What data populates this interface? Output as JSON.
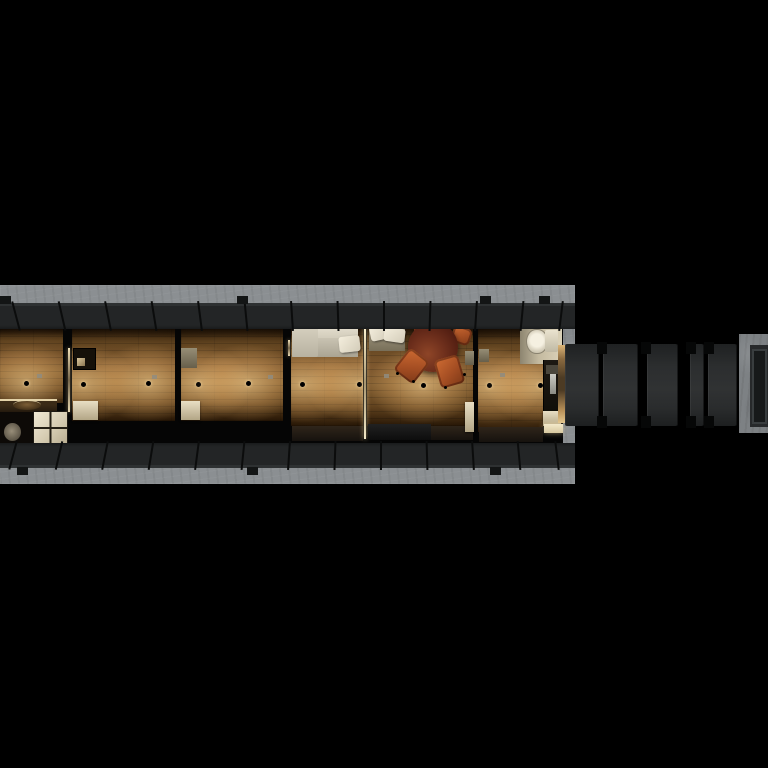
{
  "scene": {
    "title": "narrowboat-tiny-home-top-down-night-render",
    "canvas": {
      "w": 768,
      "h": 768,
      "background": "#000000"
    },
    "palette": {
      "background": "#000000",
      "concrete": "#8b8f92",
      "concrete_dark": "#6d7073",
      "hull": "#232526",
      "hull_seam": "#0b0c0c",
      "wood_mid": "#7a5427",
      "light_glow": "#ffd896",
      "sofa_cream": "#cfc9b8",
      "pillow_white": "#ece6d6",
      "table_mahogany": "#6b2d1b",
      "chair_copper": "#b35a2a",
      "cabinet_cream": "#d8cdb2",
      "tile_cream": "#d6ccb2",
      "counter_dark": "#16120d",
      "threshold_tan": "#c8a468",
      "gangway_panel": "#2b2d2e",
      "platform_frame": "#7d8184"
    },
    "dock": {
      "x": 0,
      "y": 285,
      "w": 575,
      "h": 199
    },
    "hull": {
      "interior": {
        "x": 0,
        "y": 326,
        "w": 563,
        "h": 119
      },
      "top_band": {
        "x": 0,
        "y": 303,
        "w": 575,
        "h": 26,
        "seams": [
          15,
          61,
          107,
          153,
          199,
          245,
          291,
          337,
          383,
          429,
          475,
          521,
          560
        ],
        "tabs": [
          0,
          237,
          480,
          539
        ]
      },
      "bottom_band": {
        "x": 0,
        "y": 443,
        "w": 575,
        "h": 25,
        "seams": [
          12,
          58,
          104,
          150,
          196,
          242,
          288,
          334,
          380,
          426,
          472,
          518,
          556
        ],
        "tabs": [
          17,
          247,
          490
        ]
      }
    },
    "rooms": [
      {
        "name": "cabin-1-floor",
        "x": 0,
        "y": 329,
        "w": 63,
        "h": 74
      },
      {
        "name": "cabin-2-floor",
        "x": 72,
        "y": 329,
        "w": 103,
        "h": 92
      },
      {
        "name": "cabin-3-floor",
        "x": 181,
        "y": 329,
        "w": 102,
        "h": 92
      },
      {
        "name": "lounge-floor",
        "x": 291,
        "y": 327,
        "w": 72,
        "h": 99
      },
      {
        "name": "dining-floor",
        "x": 367,
        "y": 327,
        "w": 106,
        "h": 99
      },
      {
        "name": "kitchen-floor",
        "x": 478,
        "y": 329,
        "w": 65,
        "h": 103
      }
    ],
    "objects": [
      {
        "n": "galley-counter",
        "c": "counter",
        "r": [
          0,
          399,
          57,
          13
        ]
      },
      {
        "n": "galley-sink",
        "c": "sink",
        "r": [
          13,
          400,
          28,
          9
        ]
      },
      {
        "n": "bathroom-dark-floor",
        "c": "bathdark",
        "r": [
          0,
          412,
          33,
          31
        ]
      },
      {
        "n": "bathroom-fixture",
        "c": "toiletdim",
        "r": [
          4,
          423,
          17,
          18
        ]
      },
      {
        "n": "bathroom-tile-floor",
        "c": "tiles",
        "r": [
          33,
          411,
          33,
          32
        ]
      },
      {
        "n": "door-gap-light-1",
        "c": "doorlight",
        "r": [
          68,
          348,
          2,
          64
        ]
      },
      {
        "n": "cabin-2-dark-cabinet",
        "c": "cabdark",
        "r": [
          73,
          348,
          21,
          20
        ]
      },
      {
        "n": "cabin-2-cabinet-item",
        "c": "cabitem",
        "r": [
          77,
          358,
          8,
          8
        ]
      },
      {
        "n": "cabin-2-locker",
        "c": "cabcream",
        "r": [
          73,
          401,
          25,
          19
        ]
      },
      {
        "n": "cabin-3-locker-top",
        "c": "cabcreamdim",
        "r": [
          181,
          348,
          16,
          20
        ]
      },
      {
        "n": "cabin-3-locker",
        "c": "cabcream",
        "r": [
          181,
          401,
          19,
          19
        ]
      },
      {
        "n": "door-gap-light-2",
        "c": "doorlight",
        "r": [
          288,
          340,
          2,
          16
        ]
      },
      {
        "n": "sofa-back",
        "c": "sofaback",
        "r": [
          292,
          326,
          66,
          14
        ]
      },
      {
        "n": "sofa-seat",
        "c": "sofaseat",
        "r": [
          292,
          338,
          66,
          19
        ]
      },
      {
        "n": "sofa-chaise",
        "c": "sofachaise",
        "r": [
          292,
          326,
          26,
          31
        ]
      },
      {
        "n": "sofa-pillow",
        "c": "pillow",
        "r": [
          339,
          336,
          21,
          16
        ],
        "rot": -6
      },
      {
        "n": "lounge-bench",
        "c": "bench",
        "r": [
          292,
          426,
          71,
          15
        ]
      },
      {
        "n": "door-gap-light-3",
        "c": "doorlightstrong",
        "r": [
          364,
          327,
          2,
          112
        ]
      },
      {
        "n": "dining-bench-seat",
        "c": "benchseat",
        "r": [
          369,
          325,
          36,
          26
        ]
      },
      {
        "n": "dining-pillow-1",
        "c": "pillow",
        "r": [
          370,
          325,
          19,
          15
        ],
        "rot": -12
      },
      {
        "n": "dining-pillow-2",
        "c": "pillow",
        "r": [
          384,
          328,
          21,
          14
        ],
        "rot": 8
      },
      {
        "n": "dining-chair-north-west",
        "c": "chair",
        "r": [
          414,
          326,
          14,
          8
        ]
      },
      {
        "n": "dining-chair-north-east",
        "c": "chair",
        "r": [
          452,
          327,
          19,
          17
        ],
        "rot": 18
      },
      {
        "n": "dining-table",
        "c": "table",
        "r": [
          408,
          322,
          50,
          50
        ]
      },
      {
        "n": "dining-chair-west",
        "c": "chair",
        "r": [
          399,
          352,
          25,
          28
        ],
        "rot": 38
      },
      {
        "n": "dining-chair-east",
        "c": "chair",
        "r": [
          437,
          357,
          25,
          29
        ],
        "rot": -16
      },
      {
        "n": "chair-leg-1",
        "c": "leg",
        "r": [
          412,
          380,
          3,
          3
        ]
      },
      {
        "n": "chair-leg-2",
        "c": "leg",
        "r": [
          444,
          386,
          3,
          3
        ]
      },
      {
        "n": "chair-leg-3",
        "c": "leg",
        "r": [
          463,
          373,
          3,
          3
        ]
      },
      {
        "n": "chair-leg-4",
        "c": "leg",
        "r": [
          396,
          372,
          3,
          3
        ]
      },
      {
        "n": "entry-mat",
        "c": "mat",
        "r": [
          368,
          424,
          63,
          16
        ]
      },
      {
        "n": "dining-bench-east",
        "c": "bench",
        "r": [
          431,
          426,
          42,
          14
        ]
      },
      {
        "n": "dining-cabinet-top",
        "c": "cabcreamdim",
        "r": [
          465,
          351,
          9,
          14
        ]
      },
      {
        "n": "dining-cabinet",
        "c": "cabcream",
        "r": [
          465,
          402,
          9,
          30
        ]
      },
      {
        "n": "kitchen-cabinet-smudge",
        "c": "cabcreamdim",
        "r": [
          479,
          349,
          10,
          13
        ]
      },
      {
        "n": "bathroom-corner",
        "c": "bathcorner",
        "r": [
          520,
          327,
          42,
          37
        ]
      },
      {
        "n": "toilet",
        "c": "toilet",
        "r": [
          526,
          329,
          20,
          23
        ]
      },
      {
        "n": "toilet-tank",
        "c": "toilettank",
        "r": [
          545,
          330,
          13,
          22
        ]
      },
      {
        "n": "kitchen-counter",
        "c": "kcounter",
        "r": [
          543,
          360,
          19,
          53
        ]
      },
      {
        "n": "counter-appliance",
        "c": "kitemgray",
        "r": [
          546,
          365,
          13,
          9
        ]
      },
      {
        "n": "counter-sink-slit",
        "c": "kitemwhite",
        "r": [
          550,
          374,
          6,
          20
        ]
      },
      {
        "n": "counter-item-dot",
        "c": "kitemdot",
        "r": [
          550,
          413,
          5,
          4
        ]
      },
      {
        "n": "kitchen-shelf",
        "c": "cabcream",
        "r": [
          543,
          411,
          18,
          15
        ]
      },
      {
        "n": "kitchen-shelf-lit",
        "c": "shelfbright",
        "r": [
          544,
          424,
          19,
          9
        ]
      },
      {
        "n": "kitchen-bench",
        "c": "bench",
        "r": [
          479,
          427,
          64,
          15
        ]
      }
    ],
    "ceiling_lights": [
      [
        26,
        383
      ],
      [
        83,
        384
      ],
      [
        148,
        383
      ],
      [
        198,
        384
      ],
      [
        248,
        383
      ],
      [
        302,
        384
      ],
      [
        359,
        384
      ],
      [
        423,
        385
      ],
      [
        489,
        385
      ],
      [
        540,
        385
      ]
    ],
    "ceiling_vents": [
      [
        39,
        376
      ],
      [
        154,
        377
      ],
      [
        270,
        377
      ],
      [
        386,
        376
      ],
      [
        502,
        375
      ]
    ],
    "gangway": {
      "threshold": {
        "x": 558,
        "y": 345,
        "w": 7,
        "h": 78
      },
      "band": {
        "x": 563,
        "y": 343,
        "w": 177,
        "h": 84
      },
      "panels": [
        [
          2,
          34
        ],
        [
          40,
          35
        ],
        [
          84,
          31
        ],
        [
          127,
          14
        ],
        [
          145,
          29
        ]
      ],
      "cap_seams": [
        36,
        80,
        125,
        143
      ],
      "platform": {
        "x": 739,
        "y": 334,
        "w": 29,
        "h": 99
      }
    }
  }
}
